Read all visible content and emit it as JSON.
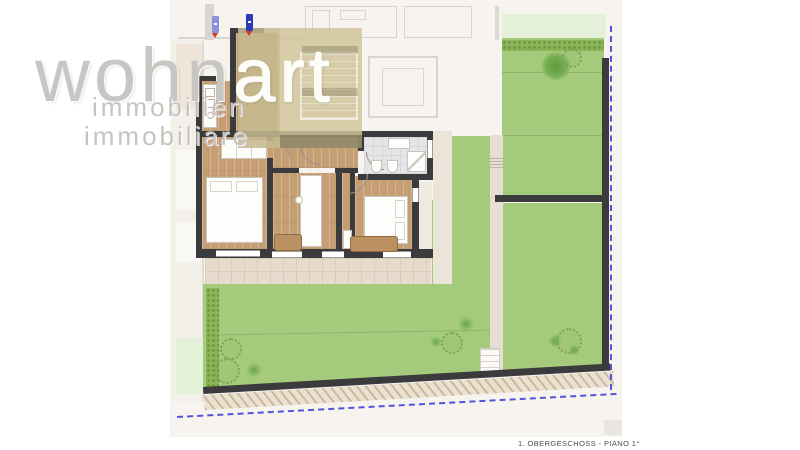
{
  "logo": {
    "word_part1": "wohn",
    "word_part2": "art",
    "line2": "immobilien",
    "line3": "immobiliare"
  },
  "caption": {
    "text": "1. OBERGESCHOSS - PIANO 1°"
  },
  "colors": {
    "wall_dark": "#3b3b3d",
    "wood_floor": "#c59e73",
    "grass_green": "#a6ca7c",
    "hedge_green": "#8ab457",
    "pale_adjacent_green": "#e4f0d8",
    "terrace_tile": "#e7dbcd",
    "stair_overlay_beige": "#d1c49a",
    "property_line_blue": "#5352e0",
    "marker_blue_dark": "#2b3bba",
    "marker_blue_light": "#8d90dd",
    "marker_red_tip": "#d03a1e",
    "logo_gray": "#c8c6c3"
  },
  "icons": {
    "tree": "soft radial green blob",
    "bush": "dotted-outline circle",
    "survey_marker_pin": "blue flag with red tip"
  }
}
